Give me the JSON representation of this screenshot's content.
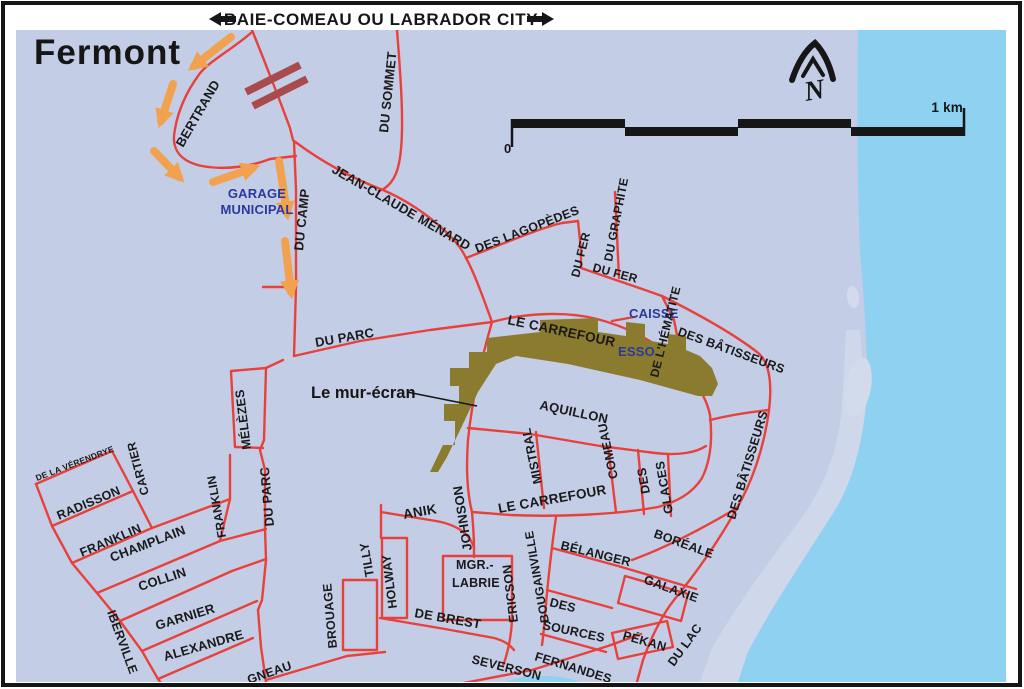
{
  "header": {
    "banner": "BAIE-COMEAU OU LABRADOR CITY",
    "title": "Fermont"
  },
  "compass": {
    "n": "N"
  },
  "scalebar": {
    "zero": "0",
    "label": "1 km"
  },
  "poi": {
    "garage_line1": "GARAGE",
    "garage_line2": "MUNICIPAL",
    "caisse": "CAISSE",
    "esso": "ESSO",
    "mur_ecran": "Le mur-écran"
  },
  "streets": {
    "bertrand": "BERTRAND",
    "du_sommet": "DU SOMMET",
    "jean_claude_menard": "JEAN-CLAUDE MÉNARD",
    "des_lagopedes": "DES LAGOPÈDES",
    "du_fer_v": "DU FER",
    "du_fer_h": "DU FER",
    "du_graphite": "DU GRAPHITE",
    "de_l_hematite": "DE L'HÉMATITE",
    "des_batisseurs_n": "DES BÂTISSEURS",
    "des_batisseurs_s": "DES BÂTISSEURS",
    "le_carrefour_n": "LE CARREFOUR",
    "le_carrefour_s": "LE CARREFOUR",
    "du_camp": "DU CAMP",
    "du_parc_h": "DU PARC",
    "du_parc_v": "DU PARC",
    "melezes": "MÉLÈZES",
    "aquillon": "AQUILLON",
    "mistral": "MISTRAL",
    "comeau": "COMEAU",
    "des_glaces_1": "DES",
    "des_glaces_2": "GLACES",
    "johnson": "JOHNSON",
    "anik": "ANIK",
    "de_la_verendrye": "DE LA VÉRENDRYE",
    "cartier": "CARTIER",
    "radisson": "RADISSON",
    "franklin_diag": "FRANKLIN",
    "franklin_vert": "FRANKLIN",
    "champlain": "CHAMPLAIN",
    "collin": "COLLIN",
    "garnier": "GARNIER",
    "alexandre": "ALEXANDRE",
    "iberville": "IBERVILLE",
    "brouage": "BROUAGE",
    "tilly": "TILLY",
    "holway": "HOLWAY",
    "mgr_labrie_1": "MGR.-",
    "mgr_labrie_2": "LABRIE",
    "ericson": "ERICSON",
    "de_brest": "DE BREST",
    "bougainville": "BOUGAINVILLE",
    "belanger": "BÉLANGER",
    "des_sources_1": "DES",
    "des_sources_2": "SOURCES",
    "boreale": "BORÉALE",
    "galaxie": "GALAXIE",
    "pekan": "PÉKAN",
    "du_lac": "DU LAC",
    "fernandes": "FERNANDES",
    "severson": "SEVERSON",
    "gneau_partial": "GNEAU"
  },
  "colors": {
    "land": "#c4cde6",
    "water": "#8fd1f0",
    "shore": "#cfd7ea",
    "island": "#d2dbec",
    "road": "#e8413b",
    "railroad": "#a94b4c",
    "arrow": "#f2a14f",
    "wall": "#8b7b2e",
    "blue_text": "#2a3a9c",
    "ink": "#161616"
  }
}
